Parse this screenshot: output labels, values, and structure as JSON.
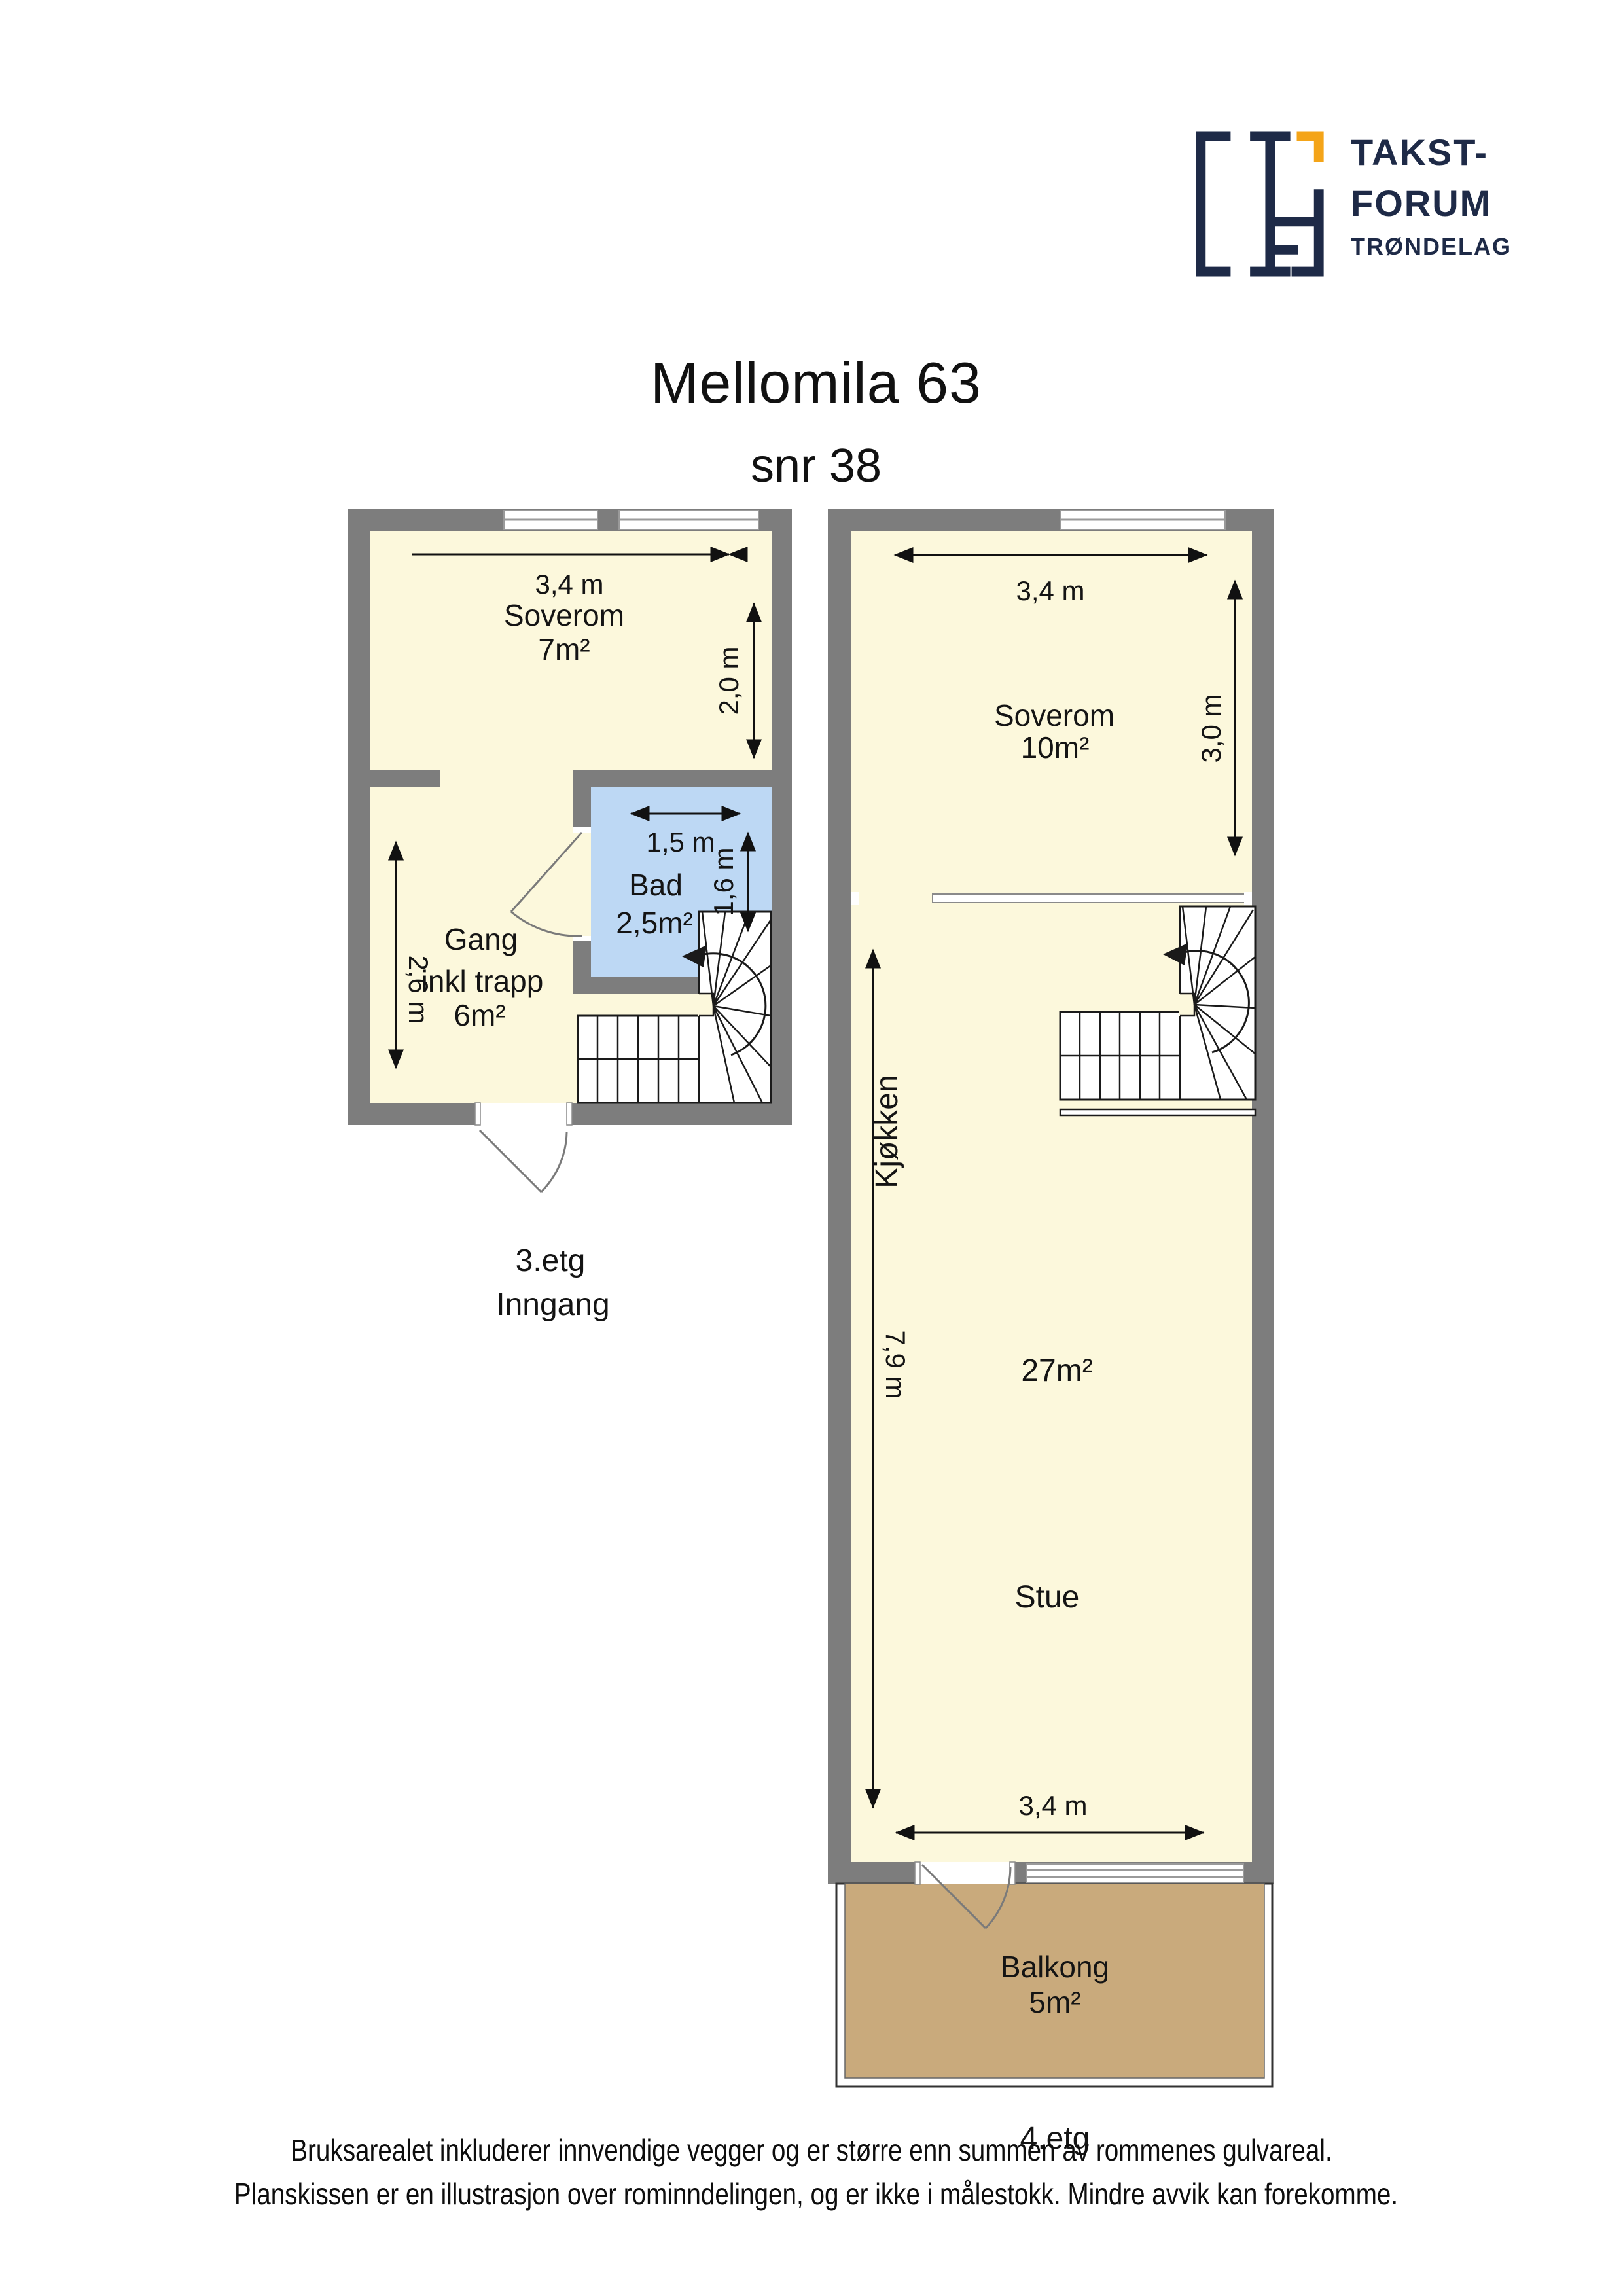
{
  "page": {
    "title": "Mellomila 63",
    "subtitle": "snr 38"
  },
  "logo": {
    "brand_line1": "TAKST-",
    "brand_line2": "FORUM",
    "brand_line3": "TRØNDELAG"
  },
  "colors": {
    "wall": "#7d7d7d",
    "room_fill": "#fcf8dc",
    "bathroom_fill": "#bdd8f4",
    "balcony_fill": "#c9aa7c",
    "logo_navy": "#1e2a47",
    "logo_orange": "#f4a418"
  },
  "plan_3etg": {
    "floor_label": "3.etg",
    "floor_sublabel": "Inngang",
    "soverom_name": "Soverom",
    "soverom_area": "7m²",
    "gang_name": "Gang",
    "gang_name2": "inkl trapp",
    "gang_area": "6m²",
    "bad_name": "Bad",
    "bad_area": "2,5m²",
    "dim_top": "3,4 m",
    "dim_right": "2,0 m",
    "dim_left": "2,6 m",
    "dim_bad_width": "1,5 m",
    "dim_bad_height": "1,6 m"
  },
  "plan_4etg": {
    "floor_label": "4.etg",
    "soverom_name": "Soverom",
    "soverom_area": "10m²",
    "kjokken_name": "Kjøkken",
    "stue_name": "Stue",
    "stue_area": "27m²",
    "balkong_name": "Balkong",
    "balkong_area": "5m²",
    "dim_top": "3,4 m",
    "dim_right": "3,0 m",
    "dim_left": "7,9 m",
    "dim_bottom": "3,4 m"
  },
  "footer": {
    "line1": "Bruksarealet inkluderer innvendige vegger og er større enn summen av rommenes gulvareal.",
    "line2": "Planskissen er en illustrasjon over rominndelingen, og er ikke i målestokk. Mindre avvik kan forekomme."
  }
}
